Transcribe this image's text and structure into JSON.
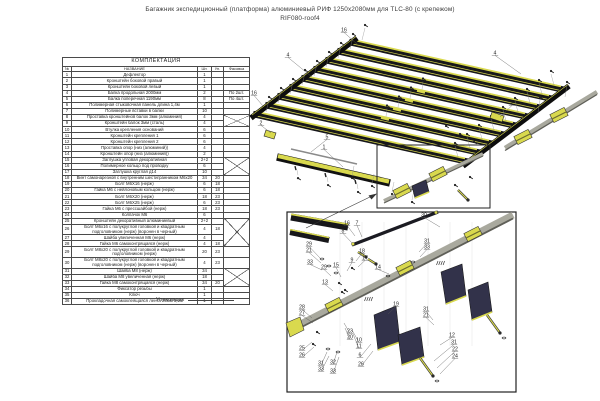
{
  "title": {
    "line1": "Багажник экспедиционный (платформа) алюминиевый РИФ 1250x2080мм для TLC-80 (с крепежом)",
    "line2": "RIF080-roof4"
  },
  "packer_label": "Упаковщик",
  "parts_table": {
    "title": "КОМПЛЕКТАЦИЯ",
    "columns": [
      "№",
      "НАЗВАНИЕ",
      "Шт.",
      "Уп.",
      "Фасовка"
    ],
    "x_groups": [
      [
        8,
        9
      ],
      [
        15,
        17
      ],
      [
        25,
        28
      ],
      [
        31,
        33
      ]
    ],
    "rows": [
      {
        "num": "1",
        "name": "Дефлектор",
        "qty": "1",
        "pack": "",
        "note": ""
      },
      {
        "num": "2",
        "name": "Кронштейн боковой правый",
        "qty": "1",
        "pack": "",
        "note": ""
      },
      {
        "num": "3",
        "name": "Кронштейн боковой левый",
        "qty": "1",
        "pack": "",
        "note": ""
      },
      {
        "num": "4",
        "name": "Балка продольная 2000мм",
        "qty": "2",
        "pack": "",
        "note": "По 2шт."
      },
      {
        "num": "5",
        "name": "Балка поперечная 1190мм",
        "qty": "8",
        "pack": "",
        "note": "По 4шт."
      },
      {
        "num": "6",
        "name": "Полимерная стыковочная панель длина 1,4м",
        "qty": "1",
        "pack": "",
        "note": ""
      },
      {
        "num": "7",
        "name": "Полимерные вставки в балки",
        "qty": "10",
        "pack": "",
        "note": ""
      },
      {
        "num": "8",
        "name": "Проставка кронштейнов балок 3мм (алюминий)",
        "qty": "4",
        "pack": "",
        "note": ""
      },
      {
        "num": "9",
        "name": "Кронштейн балок 3мм (сталь)",
        "qty": "4",
        "pack": "",
        "note": ""
      },
      {
        "num": "10",
        "name": "Втулка крепления оснований",
        "qty": "6",
        "pack": "",
        "note": ""
      },
      {
        "num": "11",
        "name": "Кронштейн крепления 1",
        "qty": "6",
        "pack": "",
        "note": ""
      },
      {
        "num": "12",
        "name": "Кронштейн крепления 2",
        "qty": "6",
        "pack": "",
        "note": ""
      },
      {
        "num": "13",
        "name": "Проставка опор (низ (алюминий))",
        "qty": "4",
        "pack": "",
        "note": ""
      },
      {
        "num": "14",
        "name": "Кронштейн опор (низ (алюминий))",
        "qty": "2",
        "pack": "",
        "note": ""
      },
      {
        "num": "15",
        "name": "Заглушка угловая декоративная",
        "qty": "2+2",
        "pack": "",
        "note": ""
      },
      {
        "num": "16",
        "name": "Полимерное кольцо под проводку",
        "qty": "6",
        "pack": "",
        "note": ""
      },
      {
        "num": "17",
        "name": "Заглушка круглая д14",
        "qty": "10",
        "pack": "",
        "note": ""
      },
      {
        "num": "18",
        "name": "Винт самонарезной с внутренним шестигранником М6х20",
        "qty": "34",
        "pack": "20",
        "note": ""
      },
      {
        "num": "19",
        "name": "Болт М6Х16 (нерж)",
        "qty": "6",
        "pack": "18",
        "note": ""
      },
      {
        "num": "20",
        "name": "Гайка М6 с нейлоновым кольцом (нерж)",
        "qty": "6",
        "pack": "18",
        "note": ""
      },
      {
        "num": "21",
        "name": "Болт М6Х20 (нерж)",
        "qty": "18",
        "pack": "23",
        "note": ""
      },
      {
        "num": "22",
        "name": "Болт М6Х25 (нерж)",
        "qty": "6",
        "pack": "23",
        "note": ""
      },
      {
        "num": "23",
        "name": "Гайка М6 с прессшайбой (нерж)",
        "qty": "18",
        "pack": "23",
        "note": ""
      },
      {
        "num": "24",
        "name": "Колпачок М6",
        "qty": "6",
        "pack": "",
        "note": ""
      },
      {
        "num": "25",
        "name": "Кронштейн декоративный алюминиевый",
        "qty": "2+2",
        "pack": "",
        "note": ""
      },
      {
        "num": "26",
        "name": "Болт М6х16 с полукруглой головкой и квадратным подголовником (нерж) (воронен в черный)",
        "qty": "4",
        "pack": "18",
        "note": ""
      },
      {
        "num": "27",
        "name": "Шайба увеличенная М6 (нерж)",
        "qty": "4",
        "pack": "",
        "note": ""
      },
      {
        "num": "28",
        "name": "Гайка М6 самоконтрящаяся (нерж)",
        "qty": "4",
        "pack": "18",
        "note": ""
      },
      {
        "num": "29",
        "name": "Болт М8х20 с полукруглой головкой и квадратным подголовником (нерж)",
        "qty": "20",
        "pack": "23",
        "note": ""
      },
      {
        "num": "30",
        "name": "Болт М8х20 с полукруглой головкой и квадратным подголовником (нерж) (воронен в черный)",
        "qty": "4",
        "pack": "23",
        "note": ""
      },
      {
        "num": "31",
        "name": "Шайба М8 (нерж)",
        "qty": "34",
        "pack": "",
        "note": ""
      },
      {
        "num": "32",
        "name": "Шайба М8 увеличенная (нерж)",
        "qty": "18",
        "pack": "",
        "note": ""
      },
      {
        "num": "33",
        "name": "Гайка М8 самоконтрящаяся (нерж)",
        "qty": "34",
        "pack": "20",
        "note": ""
      },
      {
        "num": "34",
        "name": "Фиксатор резьбы",
        "qty": "1",
        "pack": "",
        "note": ""
      },
      {
        "num": "35",
        "name": "Ключ",
        "qty": "1",
        "pack": "",
        "note": ""
      },
      {
        "num": "36",
        "name": "Прокладочная самоклеящаяся лента 25мм 3,6м",
        "qty": "1",
        "pack": "",
        "note": ""
      }
    ]
  },
  "diagram": {
    "colors": {
      "yellow": "#d9d94e",
      "dark": "#17171a",
      "gray": "#a9a99e",
      "gray_dark": "#5f5f58",
      "navy": "#32324a",
      "line": "#3c3c3c",
      "leader": "#8a8a8a"
    },
    "callouts_main": [
      {
        "label": "16",
        "x": 344,
        "y": 31,
        "tx": 357,
        "ty": 44
      },
      {
        "label": "4",
        "x": 288,
        "y": 56,
        "tx": 312,
        "ty": 77
      },
      {
        "label": "16",
        "x": 254,
        "y": 94,
        "tx": 263,
        "ty": 106
      },
      {
        "label": "4",
        "x": 495,
        "y": 54,
        "tx": 521,
        "ty": 74
      },
      {
        "label": "2",
        "x": 512,
        "y": 104,
        "tx": 500,
        "ty": 117
      },
      {
        "label": "2",
        "x": 261,
        "y": 124,
        "tx": 271,
        "ty": 133
      },
      {
        "label": "5",
        "x": 327,
        "y": 138,
        "tx": 311,
        "ty": 152
      },
      {
        "label": "1",
        "x": 324,
        "y": 148,
        "tx": 343,
        "ty": 167
      }
    ],
    "callouts_detail": [
      {
        "label": "30",
        "x": 424,
        "y": 216,
        "tx": 440,
        "ty": 227
      },
      {
        "label": "16",
        "x": 347,
        "y": 224,
        "tx": 355,
        "ty": 236
      },
      {
        "label": "7",
        "x": 357,
        "y": 224,
        "tx": 362,
        "ty": 237
      },
      {
        "label": "8",
        "x": 343,
        "y": 232,
        "tx": 352,
        "ty": 243
      },
      {
        "label": "29",
        "x": 309,
        "y": 245,
        "tx": 320,
        "ty": 258
      },
      {
        "label": "21",
        "x": 309,
        "y": 251,
        "tx": 321,
        "ty": 263
      },
      {
        "label": "33",
        "x": 310,
        "y": 263,
        "tx": 322,
        "ty": 270
      },
      {
        "label": "29",
        "x": 324,
        "y": 268,
        "tx": 331,
        "ty": 276
      },
      {
        "label": "15",
        "x": 336,
        "y": 266,
        "tx": 341,
        "ty": 277
      },
      {
        "label": "13",
        "x": 325,
        "y": 283,
        "tx": 333,
        "ty": 291
      },
      {
        "label": "9",
        "x": 352,
        "y": 261,
        "tx": 347,
        "ty": 271
      },
      {
        "label": "18",
        "x": 362,
        "y": 252,
        "tx": 356,
        "ty": 261
      },
      {
        "label": "17",
        "x": 365,
        "y": 259,
        "tx": 358,
        "ty": 267
      },
      {
        "label": "14",
        "x": 378,
        "y": 268,
        "tx": 389,
        "ty": 274
      },
      {
        "label": "31",
        "x": 427,
        "y": 242,
        "tx": 419,
        "ty": 252
      },
      {
        "label": "33",
        "x": 427,
        "y": 248,
        "tx": 420,
        "ty": 257
      },
      {
        "label": "28",
        "x": 302,
        "y": 308,
        "tx": 312,
        "ty": 318
      },
      {
        "label": "27",
        "x": 302,
        "y": 314,
        "tx": 313,
        "ty": 323
      },
      {
        "label": "25",
        "x": 302,
        "y": 349,
        "tx": 312,
        "ty": 342
      },
      {
        "label": "26",
        "x": 302,
        "y": 356,
        "tx": 314,
        "ty": 347
      },
      {
        "label": "31",
        "x": 321,
        "y": 364,
        "tx": 327,
        "ty": 352
      },
      {
        "label": "33",
        "x": 321,
        "y": 370,
        "tx": 329,
        "ty": 356
      },
      {
        "label": "32",
        "x": 333,
        "y": 363,
        "tx": 337,
        "ty": 352
      },
      {
        "label": "33",
        "x": 333,
        "y": 372,
        "tx": 339,
        "ty": 357
      },
      {
        "label": "23",
        "x": 350,
        "y": 332,
        "tx": 344,
        "ty": 323
      },
      {
        "label": "20",
        "x": 350,
        "y": 338,
        "tx": 345,
        "ty": 328
      },
      {
        "label": "10",
        "x": 359,
        "y": 341,
        "tx": 352,
        "ty": 330
      },
      {
        "label": "11",
        "x": 359,
        "y": 347,
        "tx": 353,
        "ty": 334
      },
      {
        "label": "6",
        "x": 360,
        "y": 356,
        "tx": 371,
        "ty": 344
      },
      {
        "label": "26",
        "x": 361,
        "y": 365,
        "tx": 373,
        "ty": 351
      },
      {
        "label": "19",
        "x": 396,
        "y": 305,
        "tx": 388,
        "ty": 314
      },
      {
        "label": "31",
        "x": 426,
        "y": 310,
        "tx": 433,
        "ty": 320
      },
      {
        "label": "21",
        "x": 426,
        "y": 316,
        "tx": 434,
        "ty": 325
      },
      {
        "label": "12",
        "x": 452,
        "y": 336,
        "tx": 440,
        "ty": 345
      },
      {
        "label": "31",
        "x": 454,
        "y": 343,
        "tx": 434,
        "ty": 361
      },
      {
        "label": "22",
        "x": 455,
        "y": 350,
        "tx": 437,
        "ty": 368
      },
      {
        "label": "24",
        "x": 455,
        "y": 357,
        "tx": 440,
        "ty": 374
      }
    ]
  }
}
